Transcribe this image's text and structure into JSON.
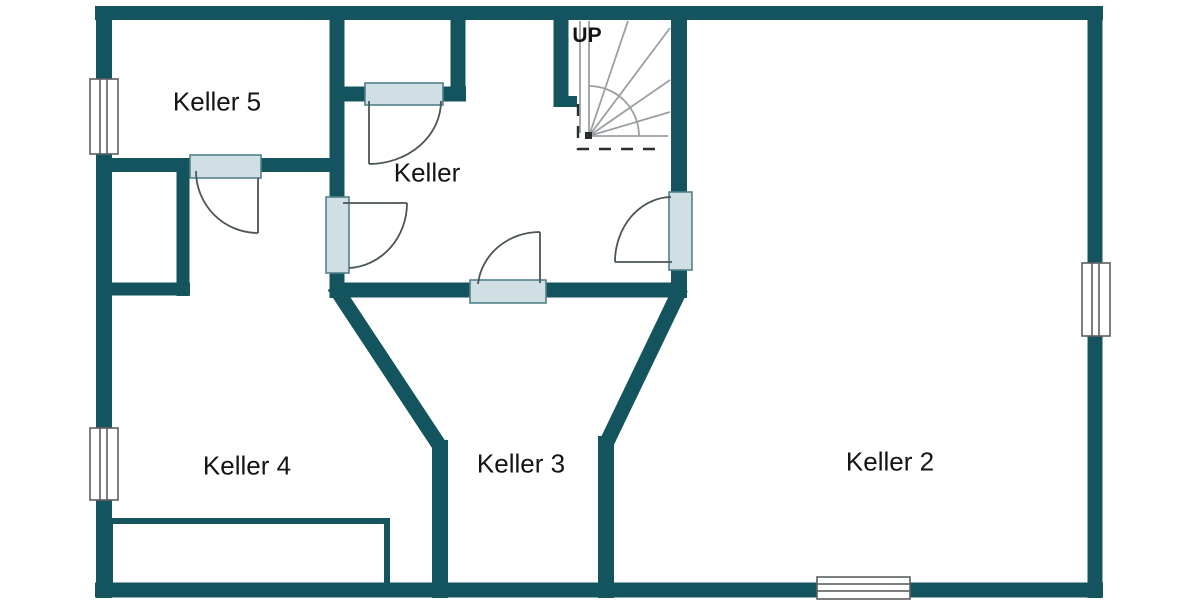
{
  "title": "Keller floor plan",
  "rooms": [
    {
      "id": "keller5",
      "label": "Keller 5"
    },
    {
      "id": "keller",
      "label": "Keller"
    },
    {
      "id": "keller4",
      "label": "Keller 4"
    },
    {
      "id": "keller3",
      "label": "Keller 3"
    },
    {
      "id": "keller2",
      "label": "Keller 2"
    }
  ],
  "stairs": {
    "label": "UP",
    "type": "quarter-turn-winder"
  },
  "counts": {
    "windows": 4,
    "doors": 5,
    "rooms": 5
  },
  "colors": {
    "wall": "#14545f",
    "leaf_fill": "#cfdfe3",
    "leaf_stroke": "#51808a",
    "swing": "#4a5557",
    "window_stroke": "#5a5f61",
    "stair": "#9aa0a2",
    "dash": "#2a2d2e",
    "text": "#141414",
    "bg": "#ffffff"
  }
}
